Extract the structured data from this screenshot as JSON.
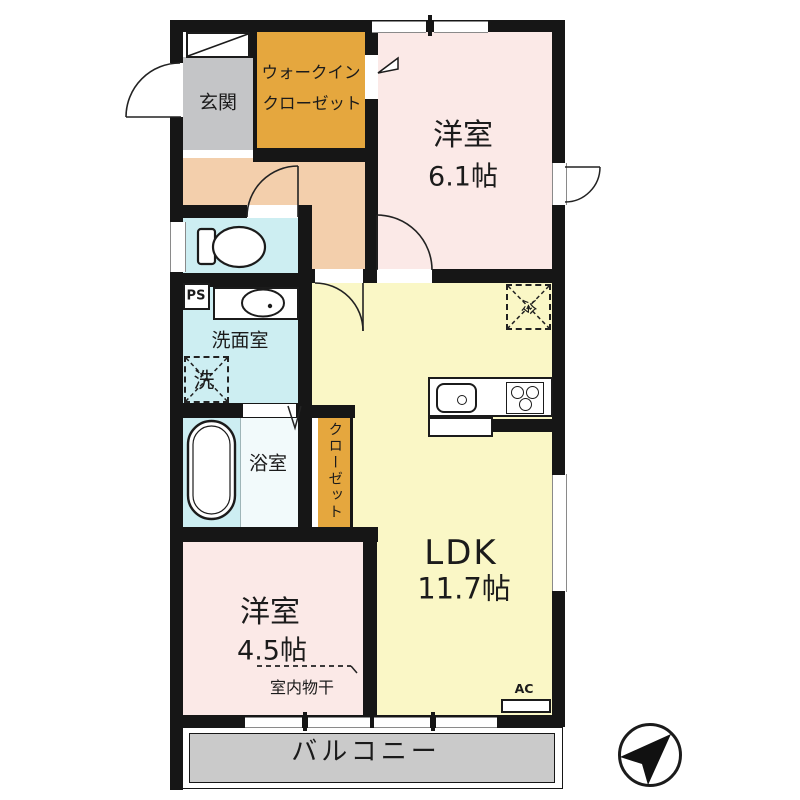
{
  "floorplan": {
    "rooms": {
      "genkan": "玄関",
      "wic_line1": "ウォークイン",
      "wic_line2": "クローゼット",
      "bedroom1_name": "洋室",
      "bedroom1_size": "6.1帖",
      "washroom": "洗面室",
      "washer": "洗",
      "bathroom": "浴室",
      "closet": "クローゼット",
      "ldk_name": "LDK",
      "ldk_size": "11.7帖",
      "fridge": "冷",
      "bedroom2_name": "洋室",
      "bedroom2_size": "4.5帖",
      "indoor_laundry": "室内物干",
      "ps": "PS",
      "ac": "AC",
      "balcony": "バルコニー"
    },
    "colors": {
      "wall": "#161616",
      "bedroom_pink": "#FBE9E7",
      "ldk_yellow": "#FAF7C6",
      "wet_area_cyan": "#CDEEF2",
      "hall_peach": "#F3CFAC",
      "closet_orange": "#E5A73E",
      "genkan_gray": "#C4C5C7",
      "balcony_gray": "#CACACA"
    }
  }
}
